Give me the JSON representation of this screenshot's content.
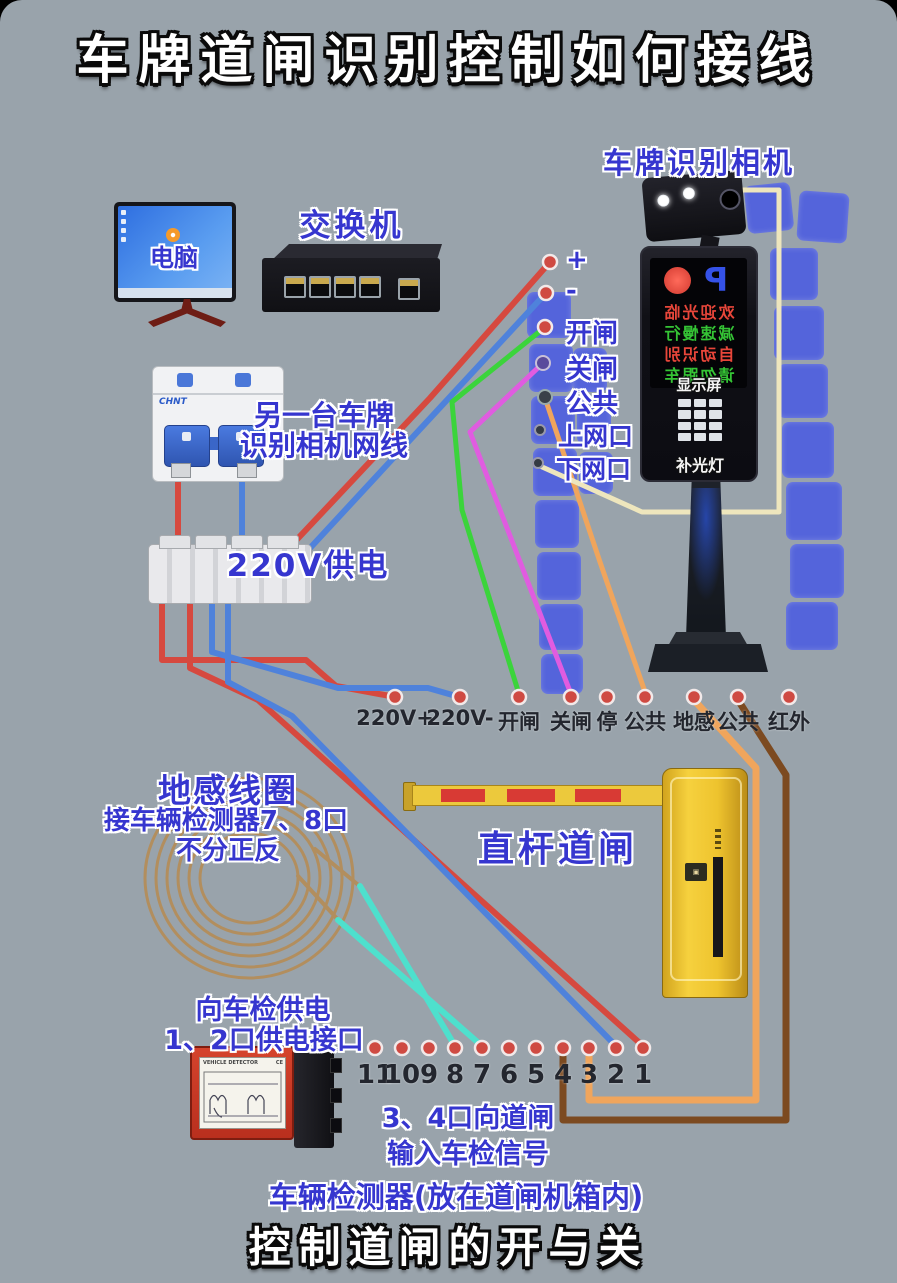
{
  "title": "车牌道闸识别控制如何接线",
  "footer": "控制道闸的开与关",
  "colors": {
    "background": "#99a3ab",
    "wire_red": "#d6493f",
    "wire_blue": "#4f82db",
    "wire_green": "#3bd43b",
    "wire_magenta": "#e05ce0",
    "wire_orange": "#f0a55c",
    "wire_brown": "#7c4a20",
    "wire_cyan": "#4ee0cd",
    "wire_cream": "#eee6bd",
    "wire_coil": "#b28e5e",
    "label_blue": "#3636cf",
    "label_dark": "#23262e",
    "square_blue": "#4b5ce2",
    "dot_red": "#cf4a42",
    "gate_yellow": "#f0c62e",
    "detector_red": "#cc3a28"
  },
  "computer": {
    "label": "电脑"
  },
  "network_switch": {
    "label": "交换机"
  },
  "camera": {
    "label": "车牌识别相机",
    "screen_p": "P",
    "led_lines": [
      "欢迎光临",
      "减速慢行",
      "自动识别",
      "请勿跟车"
    ],
    "display_label": "显示屏",
    "fill_light_label": "补光灯",
    "terminals": [
      "+",
      "-",
      "开闸",
      "关闸",
      "公共",
      "上网口",
      "下网口"
    ]
  },
  "breaker": {
    "brand": "CHNT",
    "note_line1": "另一台车牌",
    "note_line2": "识别相机网线",
    "power_label": "220V供电"
  },
  "gate_row": {
    "terminals": [
      "220V+",
      "220V-",
      "开闸",
      "关闸",
      "停",
      "公共",
      "地感",
      "公共",
      "红外"
    ]
  },
  "coil": {
    "label": "地感线圈",
    "note1": "接车辆检测器7、8口",
    "note2": "不分正反"
  },
  "barrier": {
    "label": "直杆道闸"
  },
  "detector": {
    "power_note1": "向车检供电",
    "power_note2": "1、2口供电接口",
    "device_title": "VEHICLE DETECTOR",
    "ce_mark": "CE",
    "terminals": [
      "11",
      "10",
      "9",
      "8",
      "7",
      "6",
      "5",
      "4",
      "3",
      "2",
      "1"
    ],
    "signal_note1": "3、4口向道闸",
    "signal_note2": "输入车检信号",
    "caption": "车辆检测器(放在道闸机箱内)"
  }
}
